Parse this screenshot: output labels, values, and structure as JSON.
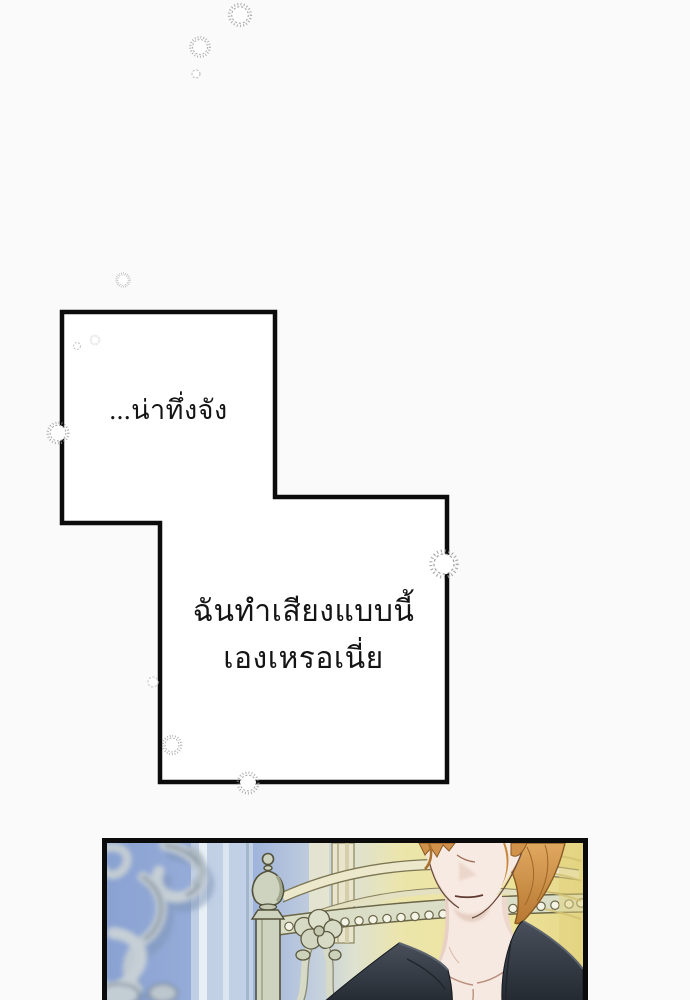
{
  "speech": {
    "bubble1": {
      "text": "...น่าทึ่งจัง"
    },
    "bubble2": {
      "line1": "ฉันทำเสียงแบบนี้",
      "line2": "เองเหรอเนี่ย"
    }
  },
  "icons": {
    "sparkle": "burst-ring",
    "sparkle_dot": "small-ring"
  },
  "colors": {
    "page_bg": "#fafafa",
    "bubble_fill": "#ffffff",
    "ink": "#0c0c0c",
    "sparkle": "#9b9b9b",
    "panel_border": "#0b0b0b",
    "panel_sky": "#8fa7d5",
    "panel_gold": "#ecdf90",
    "chair_wood": "#ced3bf",
    "hair": "#d0924a",
    "skin": "#f6e9e1",
    "jacket_dark": "#2b313a"
  }
}
